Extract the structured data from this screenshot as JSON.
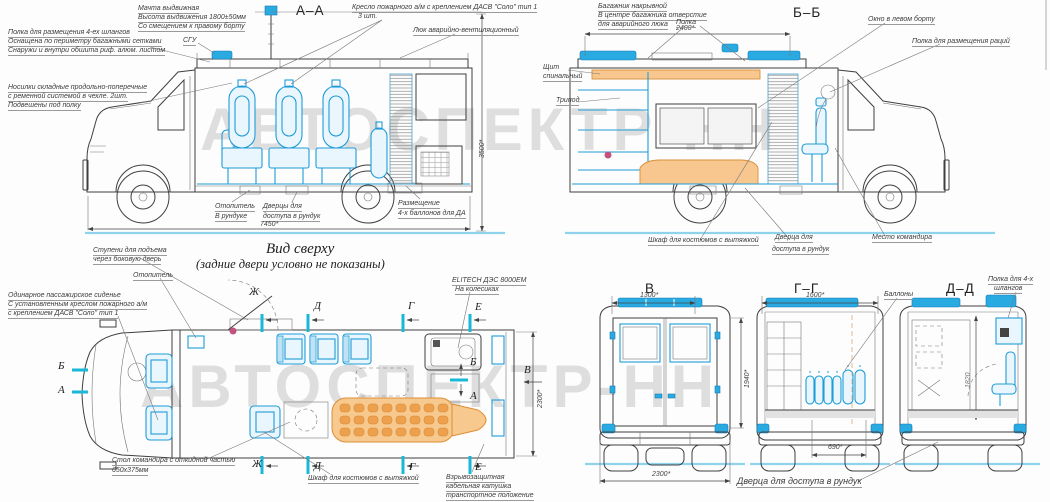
{
  "watermark": {
    "text": "АВТОСПЕКТР-НН"
  },
  "colors": {
    "accent": "#29abe2",
    "orange": "#f7c78f",
    "line": "#3f3f3f",
    "ground": "#8fd2ee",
    "watermark": "#dedede"
  },
  "titles": {
    "section_aa": "А–А",
    "section_bb": "Б–Б",
    "rear_v": "В",
    "section_gg": "Г–Г",
    "section_dd": "Д–Д",
    "view_top_1": "Вид сверху",
    "view_top_2": "(задние двери условно не показаны)"
  },
  "aa": {
    "mast": [
      "Мачта выдвижная",
      "Высота выдвижения 1800±50мм",
      "Со смещением к правому борту"
    ],
    "shelf": [
      "Полка для размещения 4-ех шлангов",
      "Оснащена по периметру багажными сетками",
      "Снаружи и внутри обшита риф. алюм. листом"
    ],
    "sgu": "СГУ",
    "stretcher": [
      "Носилки складные продольно-поперечные",
      "с ременной системой в чехле. 2шт.",
      "Подвешены под полку"
    ],
    "seat": [
      "Кресло пожарного а/м с креплением ДАСВ \"Соло\" тип 1",
      "3 шт."
    ],
    "hatch": "Люк аварийно-вентиляционный",
    "heater": [
      "Отопитель",
      "В рундуке"
    ],
    "doors": [
      "Дверцы для",
      "доступа в рундук"
    ],
    "bottles": [
      "Размещение",
      "4-х баллонов для ДА"
    ],
    "dim_length": "7450*",
    "dim_height": "3500*"
  },
  "bb": {
    "rack": [
      "Багажник накрывной",
      "В центре багажника отверстие",
      "для аварийного люка"
    ],
    "dim_rack": "2400*",
    "shelf": "Полка",
    "window": "Окно в левом борту",
    "radio_shelf": "Полка для размещения раций",
    "spine_board": [
      "Щит",
      "спинальный"
    ],
    "tripod": "Трипод",
    "wardrobe": "Шкаф для костюмов с вытяжкой",
    "hatch_door": [
      "Дверца для",
      "доступа в рундук"
    ],
    "commander": "Место командира"
  },
  "top": {
    "steps": [
      "Ступени для подъема",
      "через боковую дверь"
    ],
    "heater": "Отопитель",
    "single_seat": [
      "Одинарное пассажирское сиденье",
      "С установленным креслом пожарного а/м",
      "с креплением ДАСВ \"Соло\" тип 1"
    ],
    "generator": [
      "ELITECH ДЭС 8000ЕМ",
      "На колесиках"
    ],
    "table": [
      "Стол командира с откидной частью",
      "650х375мм"
    ],
    "wardrobe": "Шкаф для костюмов с вытяжкой",
    "cable_reel": [
      "Взрывозащитная",
      "кабельная катушка",
      "транспортное положение"
    ],
    "dim_width": "2300*",
    "marks": {
      "zh": "Ж",
      "d": "Д",
      "g": "Г",
      "e": "Е",
      "b": "Б",
      "a": "А",
      "v": "В"
    }
  },
  "rear": {
    "v_dim_top": "1300*",
    "v_dim_height": "1940*",
    "v_dim_width": "2300*",
    "gg_dim_top": "1600*",
    "gg_dim_bottom": "690*",
    "cylinders": "Баллоны",
    "dd_shelf": [
      "Полка для 4-х",
      "шлангов"
    ],
    "dd_dim_height": "1820",
    "hatch_door": "Дверца для доступа в рундук"
  }
}
